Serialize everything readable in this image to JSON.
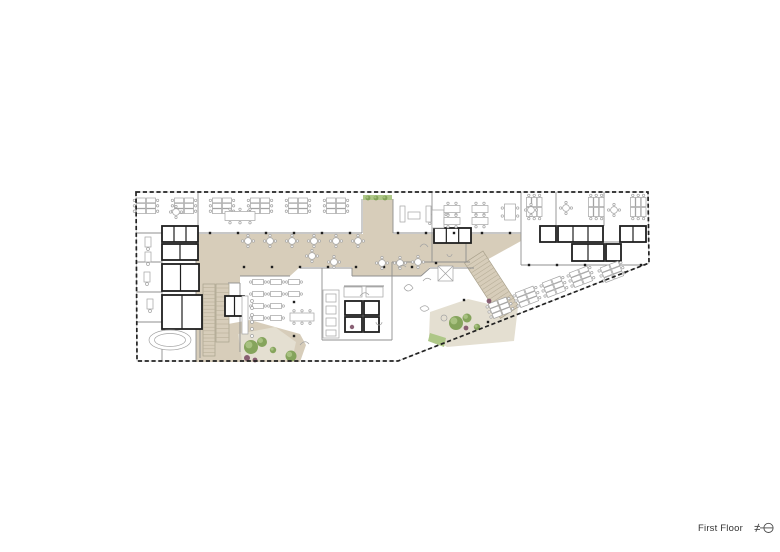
{
  "footer": {
    "label": "First Floor",
    "icon": "north-arrow"
  },
  "colors": {
    "page": "#ffffff",
    "beige": "#d7cdba",
    "terrace": "#e4dfd1",
    "tread": "#b9b09a",
    "treadEdge": "#a9a18c",
    "wall": "#8f8f8f",
    "core": "#1f1f1f",
    "dash": "#222222",
    "facade": "#bdbdbd",
    "furn": "#a3a3a3",
    "treeDark": "#7fa055",
    "treeLight": "#aec787",
    "shrub": "#7d5066",
    "text": "#333333"
  },
  "plan": {
    "outline": "136,192 648,192 649,263 398,361 137,361",
    "beige_regions": [
      {
        "name": "spine",
        "points": "196,234 363,234 363,199 393,199 393,234 521,234 521,241 474,267 430,267 421,276 352,276 352,267 300,267 290,276 240,276 240,234"
      },
      {
        "name": "west-arm",
        "points": "196,234 240,234 240,283 228,283 228,362 196,362"
      },
      {
        "name": "terrace-surround",
        "points": "228,324 250,320 300,334 306,345 300,362 228,362"
      }
    ],
    "terrace_regions": [
      {
        "name": "terrace-center",
        "points": "238,334 275,327 296,342 292,360 242,360"
      },
      {
        "name": "terrace-east",
        "points": "430,312 468,299 497,306 518,307 514,341 447,347 429,336"
      }
    ],
    "green_strips": [
      {
        "points": "363,195 392,195 392,200 363,200"
      },
      {
        "points": "430,333 446,338 444,347 428,341"
      }
    ],
    "stairs": [
      {
        "x": 203,
        "y": 356,
        "rot": -90,
        "len": 72,
        "w": 12,
        "step": 3.6
      },
      {
        "x": 216,
        "y": 342,
        "rot": -90,
        "len": 58,
        "w": 13,
        "step": 4.5
      },
      {
        "x": 483,
        "y": 251,
        "rot": 57,
        "len": 66,
        "w": 22,
        "step": 4
      }
    ],
    "walls": [
      [
        137,
        233,
        362,
        233
      ],
      [
        393,
        233,
        521,
        233
      ],
      [
        198,
        192,
        198,
        233
      ],
      [
        362,
        199,
        362,
        233
      ],
      [
        393,
        199,
        393,
        233
      ],
      [
        432,
        192,
        432,
        233
      ],
      [
        521,
        192,
        521,
        233
      ],
      [
        556,
        192,
        556,
        226
      ],
      [
        604,
        192,
        604,
        226
      ],
      [
        432,
        233,
        432,
        262
      ],
      [
        466,
        233,
        466,
        262
      ],
      [
        432,
        262,
        470,
        262
      ],
      [
        392,
        262,
        432,
        262
      ],
      [
        521,
        233,
        521,
        265
      ],
      [
        521,
        265,
        646,
        265
      ],
      [
        540,
        242,
        646,
        242
      ],
      [
        137,
        262,
        162,
        262
      ],
      [
        137,
        292,
        162,
        292
      ],
      [
        137,
        322,
        162,
        322
      ],
      [
        162,
        233,
        162,
        296
      ],
      [
        162,
        330,
        162,
        361
      ],
      [
        140,
        322,
        200,
        322
      ],
      [
        200,
        322,
        200,
        358
      ],
      [
        196,
        234,
        196,
        362
      ],
      [
        240,
        276,
        290,
        276
      ],
      [
        300,
        268,
        352,
        268
      ],
      [
        352,
        268,
        352,
        276
      ],
      [
        352,
        276,
        421,
        276
      ],
      [
        421,
        276,
        430,
        268
      ],
      [
        430,
        268,
        474,
        268
      ],
      [
        322,
        268,
        322,
        340
      ],
      [
        322,
        340,
        392,
        340
      ],
      [
        392,
        262,
        392,
        340
      ],
      [
        240,
        283,
        240,
        352
      ],
      [
        228,
        283,
        240,
        283
      ],
      [
        344,
        286,
        384,
        286
      ],
      [
        434,
        243,
        471,
        243
      ]
    ],
    "cores": [
      [
        162,
        226,
        36,
        16,
        3
      ],
      [
        162,
        244,
        36,
        16,
        2
      ],
      [
        162,
        264,
        37,
        27,
        2
      ],
      [
        162,
        295,
        40,
        34,
        2
      ],
      [
        225,
        296,
        19,
        20,
        2
      ],
      [
        345,
        301,
        17,
        14,
        1
      ],
      [
        364,
        301,
        15,
        14,
        1
      ],
      [
        345,
        317,
        17,
        15,
        1
      ],
      [
        364,
        317,
        15,
        15,
        1
      ],
      [
        540,
        226,
        16,
        16,
        1
      ],
      [
        558,
        226,
        45,
        16,
        3
      ],
      [
        620,
        226,
        26,
        16,
        2
      ],
      [
        572,
        244,
        32,
        17,
        2
      ],
      [
        606,
        244,
        15,
        17,
        1
      ],
      [
        434,
        228,
        37,
        15,
        3
      ]
    ],
    "columns": [
      [
        210,
        233
      ],
      [
        238,
        233
      ],
      [
        266,
        233
      ],
      [
        294,
        233
      ],
      [
        322,
        233
      ],
      [
        350,
        233
      ],
      [
        398,
        233
      ],
      [
        426,
        233
      ],
      [
        454,
        233
      ],
      [
        482,
        233
      ],
      [
        510,
        233
      ],
      [
        244,
        267
      ],
      [
        272,
        267
      ],
      [
        300,
        267
      ],
      [
        328,
        267
      ],
      [
        356,
        267
      ],
      [
        384,
        267
      ],
      [
        412,
        267
      ],
      [
        440,
        267
      ],
      [
        294,
        302
      ],
      [
        294,
        336
      ],
      [
        436,
        263
      ],
      [
        464,
        300
      ],
      [
        488,
        322
      ],
      [
        529,
        265
      ],
      [
        557,
        265
      ],
      [
        585,
        265
      ],
      [
        613,
        265
      ],
      [
        641,
        265
      ]
    ],
    "desk_clusters": [
      [
        146,
        206,
        0
      ],
      [
        184,
        206,
        0
      ],
      [
        222,
        206,
        0
      ],
      [
        260,
        206,
        0
      ],
      [
        298,
        206,
        0
      ],
      [
        336,
        206,
        0
      ],
      [
        534,
        207,
        90
      ],
      [
        596,
        207,
        90
      ],
      [
        638,
        207,
        90
      ],
      [
        500,
        308,
        -21
      ],
      [
        527,
        297,
        -21
      ],
      [
        554,
        287,
        -21
      ],
      [
        581,
        277,
        -21
      ],
      [
        612,
        272,
        -21
      ]
    ],
    "single_desks": [
      [
        148,
        242,
        90
      ],
      [
        148,
        257,
        90
      ],
      [
        147,
        277,
        90
      ],
      [
        150,
        304,
        90
      ]
    ],
    "round_tables": [
      [
        248,
        241
      ],
      [
        270,
        241
      ],
      [
        292,
        241
      ],
      [
        314,
        241
      ],
      [
        336,
        241
      ],
      [
        358,
        241
      ],
      [
        312,
        256
      ],
      [
        334,
        262
      ],
      [
        382,
        263
      ],
      [
        400,
        263
      ],
      [
        418,
        262
      ],
      [
        566,
        208
      ],
      [
        614,
        210
      ],
      [
        176,
        212
      ],
      [
        531,
        210
      ]
    ],
    "small_tables": [
      [
        258,
        282
      ],
      [
        276,
        282
      ],
      [
        258,
        294
      ],
      [
        276,
        294
      ],
      [
        258,
        306
      ],
      [
        276,
        306
      ],
      [
        258,
        318
      ],
      [
        276,
        318
      ],
      [
        294,
        282
      ],
      [
        294,
        294
      ]
    ],
    "long_tables": [
      {
        "x": 240,
        "y": 216,
        "w": 30,
        "h": 9
      },
      {
        "x": 302,
        "y": 317,
        "w": 24,
        "h": 8
      },
      {
        "x": 438,
        "y": 219,
        "w": 12,
        "h": 18
      },
      {
        "x": 510,
        "y": 212,
        "w": 11,
        "h": 16
      },
      {
        "x": 452,
        "y": 209,
        "w": 16,
        "h": 7
      },
      {
        "x": 452,
        "y": 221,
        "w": 16,
        "h": 7
      },
      {
        "x": 480,
        "y": 209,
        "w": 16,
        "h": 7
      },
      {
        "x": 480,
        "y": 221,
        "w": 16,
        "h": 7
      }
    ],
    "misc_rects": [
      {
        "x": 242,
        "y": 296,
        "w": 6,
        "h": 38
      },
      {
        "x": 323,
        "y": 290,
        "w": 16,
        "h": 48
      },
      {
        "x": 326,
        "y": 294,
        "w": 10,
        "h": 8
      },
      {
        "x": 326,
        "y": 306,
        "w": 10,
        "h": 8
      },
      {
        "x": 326,
        "y": 318,
        "w": 10,
        "h": 8
      },
      {
        "x": 326,
        "y": 330,
        "w": 10,
        "h": 6
      },
      {
        "x": 344,
        "y": 287,
        "w": 18,
        "h": 10
      },
      {
        "x": 366,
        "y": 287,
        "w": 17,
        "h": 10
      },
      {
        "x": 400,
        "y": 206,
        "w": 5,
        "h": 16
      },
      {
        "x": 426,
        "y": 206,
        "w": 5,
        "h": 16
      },
      {
        "x": 408,
        "y": 212,
        "w": 12,
        "h": 7
      }
    ],
    "hatch_square": {
      "x": 438,
      "y": 266,
      "w": 15,
      "h": 15
    },
    "misc_circles": [
      [
        252,
        301,
        1.5
      ],
      [
        252,
        308,
        1.5
      ],
      [
        252,
        315,
        1.5
      ],
      [
        252,
        322,
        1.5
      ],
      [
        252,
        329,
        1.5
      ],
      [
        252,
        336,
        1.5
      ]
    ],
    "oval_table": {
      "x": 170,
      "y": 340,
      "rx": 21,
      "ry": 10
    },
    "sketches": [
      "M404,288 q5,-7 9,0 q-5,6 -9,0",
      "M420,308 q6,-5 9,1 q-6,5 -9,-1",
      "M441,318 a3,3 0 1,0 6,0 a3,3 0 1,0 -6,0",
      "M398,268 q4,-5 8,-1",
      "M423,281 q4,-5 8,-1",
      "M300,345 q5,-6 9,-1",
      "M360,296 q5,-6 9,-1",
      "M376,322 a3,3 0 1,0 6,0",
      "M420,247 q4,-6 8,0",
      "M447,254 a2.5,2.5 0 1,0 5,0"
    ],
    "trees": [
      {
        "x": 251,
        "y": 347,
        "r": 7
      },
      {
        "x": 262,
        "y": 342,
        "r": 5
      },
      {
        "x": 291,
        "y": 356,
        "r": 5.5
      },
      {
        "x": 273,
        "y": 350,
        "r": 3.2
      },
      {
        "x": 456,
        "y": 323,
        "r": 7
      },
      {
        "x": 467,
        "y": 318,
        "r": 4.5
      },
      {
        "x": 477,
        "y": 327,
        "r": 3.2
      },
      {
        "x": 368,
        "y": 198,
        "r": 2.4
      },
      {
        "x": 376,
        "y": 198,
        "r": 2.4
      },
      {
        "x": 385,
        "y": 198,
        "r": 2.4
      }
    ],
    "shrubs": [
      {
        "x": 247,
        "y": 358,
        "r": 3
      },
      {
        "x": 255,
        "y": 360,
        "r": 2.4
      },
      {
        "x": 466,
        "y": 328,
        "r": 2.4
      },
      {
        "x": 489,
        "y": 301,
        "r": 2.4
      },
      {
        "x": 352,
        "y": 327,
        "r": 2.2
      }
    ]
  }
}
